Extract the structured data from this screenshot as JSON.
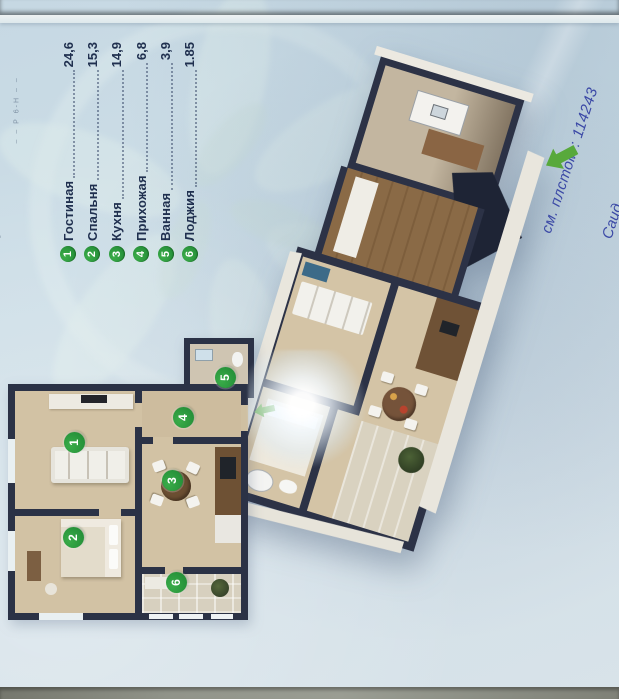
{
  "legend": {
    "items": [
      {
        "num": "1",
        "label": "Гостиная",
        "area": "24,6"
      },
      {
        "num": "2",
        "label": "Спальня",
        "area": "15,3"
      },
      {
        "num": "3",
        "label": "Кухня",
        "area": "14,9"
      },
      {
        "num": "4",
        "label": "Прихожая",
        "area": "6,8"
      },
      {
        "num": "5",
        "label": "Ванная",
        "area": "3,9"
      },
      {
        "num": "6",
        "label": "Лоджия",
        "area": "1.85"
      }
    ]
  },
  "annotations": {
    "handwriting_line1": "см. плстом : 114243",
    "handwriting_line2": "Саид",
    "edge_marks_1": "– –  Р 6-Н  – –",
    "edge_marks_2": "+ в"
  },
  "colors": {
    "paper": "#cfdfe8",
    "wall": "#2b3246",
    "floor_beige": "#d2c2a4",
    "wood": "#7a5a3c",
    "marker_green": "#2f9e3e",
    "pen_blue": "#3b49a6",
    "arrow_green": "#58a93c",
    "table_edge": "#6b4a2e",
    "bottom_surface": "#8d9086"
  }
}
